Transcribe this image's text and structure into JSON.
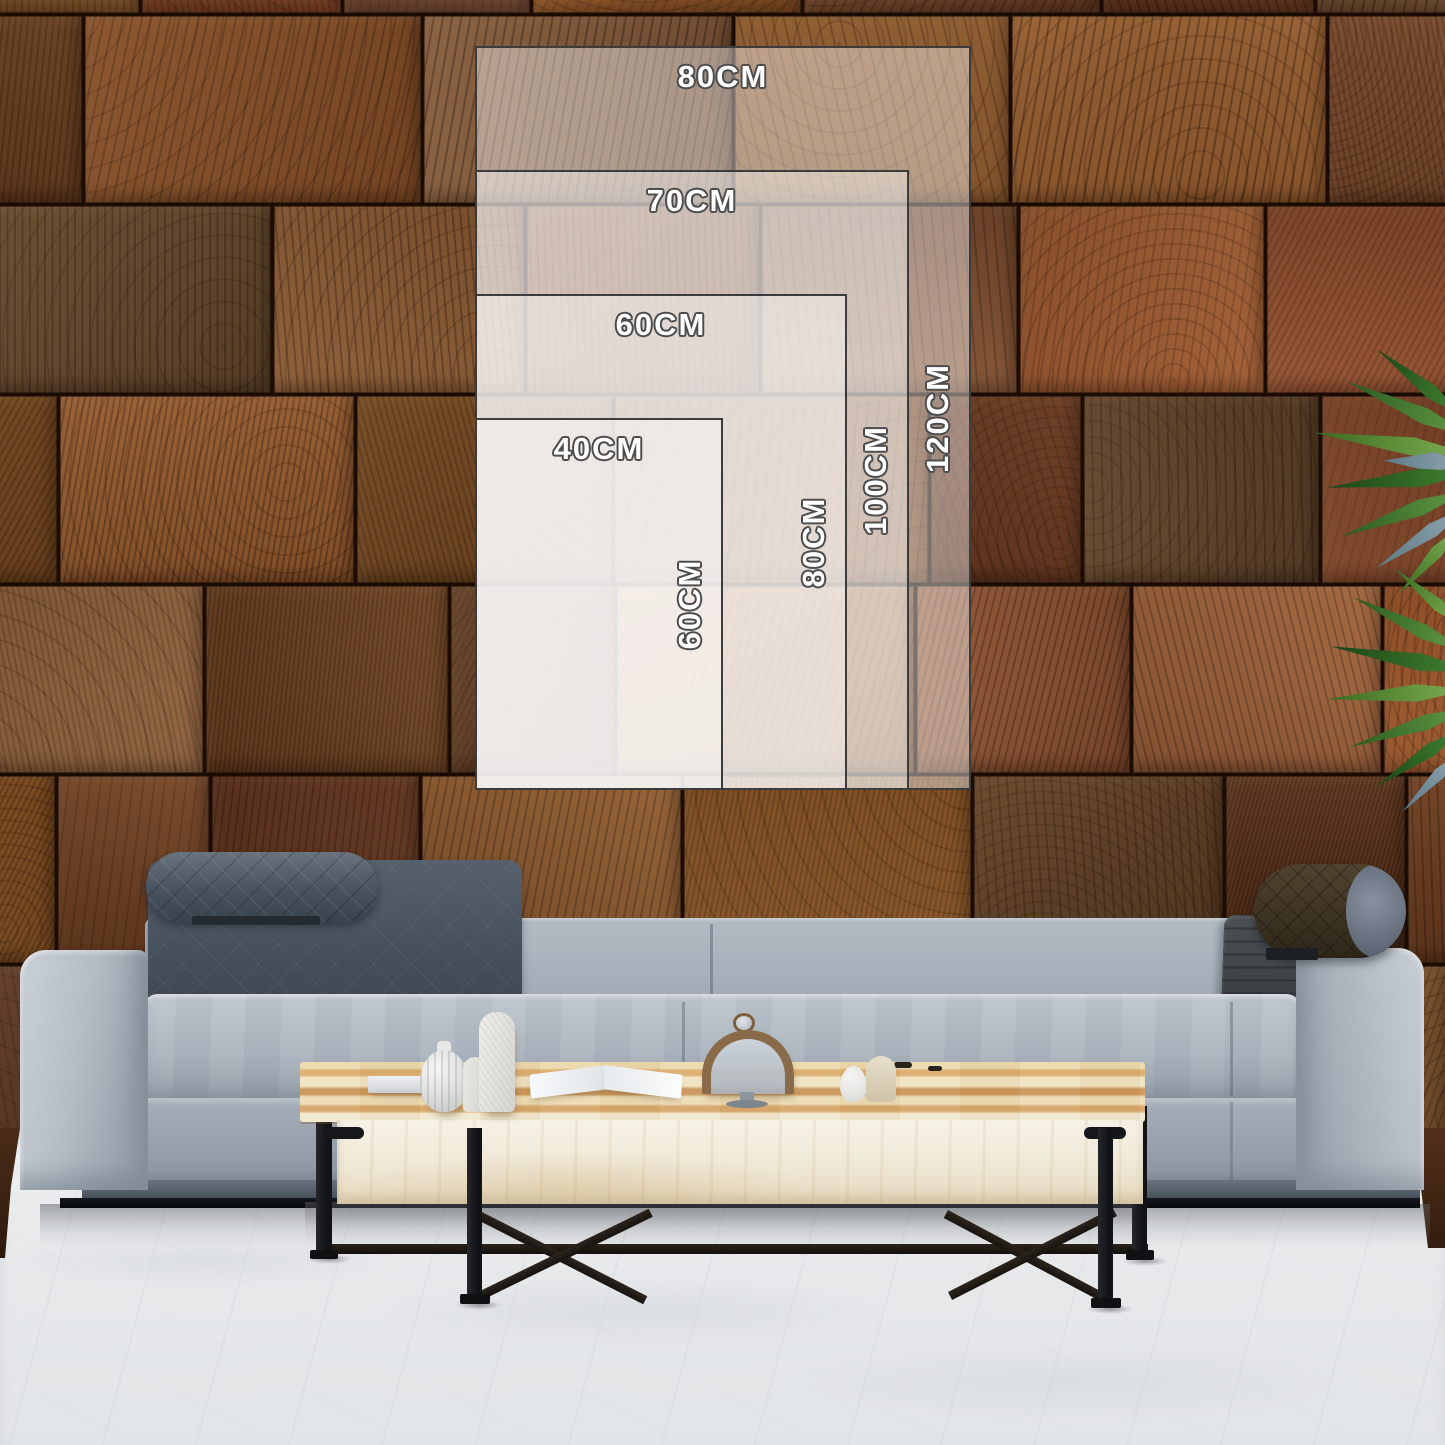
{
  "size_guide": {
    "unit_suffix": "CM",
    "sizes": [
      {
        "width_cm": 80,
        "height_cm": 120,
        "width_label": "80CM",
        "height_label": "120CM"
      },
      {
        "width_cm": 70,
        "height_cm": 100,
        "width_label": "70CM",
        "height_label": "100CM"
      },
      {
        "width_cm": 60,
        "height_cm": 80,
        "width_label": "60CM",
        "height_label": "80CM"
      },
      {
        "width_cm": 40,
        "height_cm": 60,
        "width_label": "40CM",
        "height_label": "60CM"
      }
    ],
    "style": {
      "fill": "rgba(255,255,255,0.42)",
      "border_color": "#3c3c3c",
      "label_color": "#ffffff",
      "label_outline": "#4d4d4d"
    },
    "layout": {
      "px_per_cm": 6.2,
      "left_px": 475,
      "bottom_px": 790,
      "top_label_offset_px": 11,
      "side_label_offset_px": 31
    }
  },
  "palette": {
    "wall_seam": "#241107",
    "wall_brown_dark": "#4e2e18",
    "wall_brown_mid": "#7a4a28",
    "wall_brown_light": "#a0734a",
    "sofa_fabric": "#a9b2bc",
    "sofa_fabric_shadow": "#8e98a3",
    "quilt_cushion": "#49545f",
    "leather_bolster": "#3e3326",
    "bolster_cap_gray": "#6b7584",
    "sofa_plinth": "#555e68",
    "base_black": "#14171a",
    "table_wood_light": "#f2e9d0",
    "table_wood_warm": "#ca9659",
    "table_face": "#f3eee2",
    "metal_black": "#1b1d1f",
    "floor": "#eceef0",
    "plant_green": "#3f7d2e",
    "plant_green_dark": "#1c4416",
    "plant_gray_green": "#7a98a5"
  }
}
